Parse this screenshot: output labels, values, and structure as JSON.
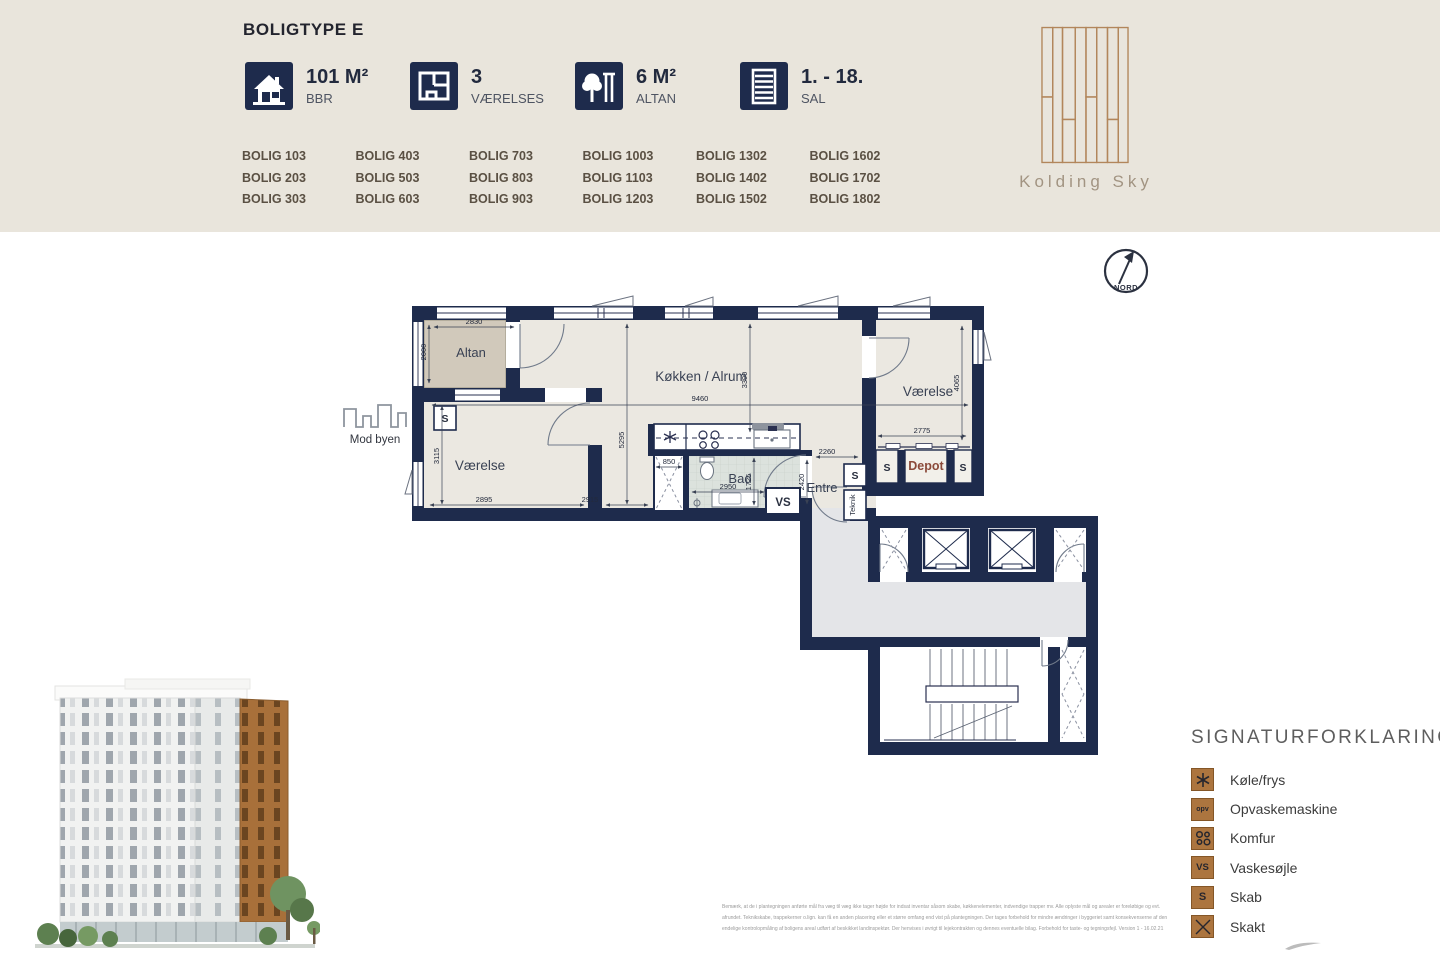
{
  "header": {
    "title": "BOLIGTYPE E",
    "stats": [
      {
        "value": "101 M²",
        "label": "BBR"
      },
      {
        "value": "3",
        "label": "VÆRELSES"
      },
      {
        "value": "6 M²",
        "label": "ALTAN"
      },
      {
        "value": "1. - 18.",
        "label": "SAL"
      }
    ],
    "units": [
      "BOLIG 103",
      "BOLIG 203",
      "BOLIG 303",
      "BOLIG 403",
      "BOLIG 503",
      "BOLIG 603",
      "BOLIG 703",
      "BOLIG 803",
      "BOLIG 903",
      "BOLIG 1003",
      "BOLIG 1103",
      "BOLIG 1203",
      "BOLIG 1302",
      "BOLIG 1402",
      "BOLIG 1502",
      "BOLIG 1602",
      "BOLIG 1702",
      "BOLIG 1802"
    ],
    "brand": "Kolding Sky"
  },
  "compass": {
    "label": "NORD"
  },
  "plan": {
    "direction_label": "Mod byen",
    "rooms": {
      "altan": "Altan",
      "vaerelse1": "Værelse",
      "koekken": "Køkken / Alrum",
      "bad": "Bad",
      "entre": "Entre",
      "vaerelse2": "Værelse",
      "depot": "Depot",
      "teknik": "Teknik"
    },
    "markers": {
      "s": "S",
      "vs": "VS"
    },
    "dims": {
      "altan_w": "2830",
      "altan_d": "2000",
      "living_w": "9460",
      "living_d": "3390",
      "kitchen_d": "5295",
      "room1_d": "3115",
      "room1_w": "2895",
      "living_b": "2915",
      "skakt_w": "850",
      "bad_w": "2950",
      "bad_d": "1725",
      "entre_w": "2260",
      "entre_d": "2420",
      "room2_w": "2775",
      "room2_d": "4065"
    }
  },
  "legend": {
    "title": "SIGNATURFORKLARING",
    "items": [
      {
        "symbol": "asterisk-icon",
        "label": "Køle/frys"
      },
      {
        "symbol": "opv-icon",
        "label": "Opvaskemaskine"
      },
      {
        "symbol": "burners-icon",
        "label": "Komfur"
      },
      {
        "symbol": "vs-icon",
        "label": "Vaskesøjle"
      },
      {
        "symbol": "s-icon",
        "label": "Skab"
      },
      {
        "symbol": "cross-icon",
        "label": "Skakt"
      }
    ],
    "symbol_text": {
      "opv": "opv",
      "vs": "VS",
      "s": "S"
    }
  },
  "disclaimer": [
    "Bemærk, at de i plantegningen anførte mål fra væg til væg ikke tager højde for indsat inventar såsom skabe, køkkenelementer, indvendige trapper mv. Alle oplyste mål og arealer er foreløbige og evt.",
    "afrundet. Teknikskabe, trappekerner o.lign. kan få en anden placering eller et større omfang end vist på plantegningen. Der tages forbehold for mindre ændringer i byggeriet samt konsekvenserne af den",
    "endelige kontrolopmåling af boligens areal udført af beskikket landinspektør. Der henvises i øvrigt til lejekontrakten og dennes eventuelle bilag. Forbehold for taste- og tegningsfejl. Version 1 - 16.02.21"
  ],
  "colors": {
    "navy": "#1e2b4c",
    "header_beige": "#e9e5dc",
    "room_fill": "#ebe8e1",
    "altan_fill": "#d1c9bb",
    "corridor_fill": "#e4e5e8",
    "bronze": "#ac753f",
    "depot_text": "#8b4a3a"
  }
}
